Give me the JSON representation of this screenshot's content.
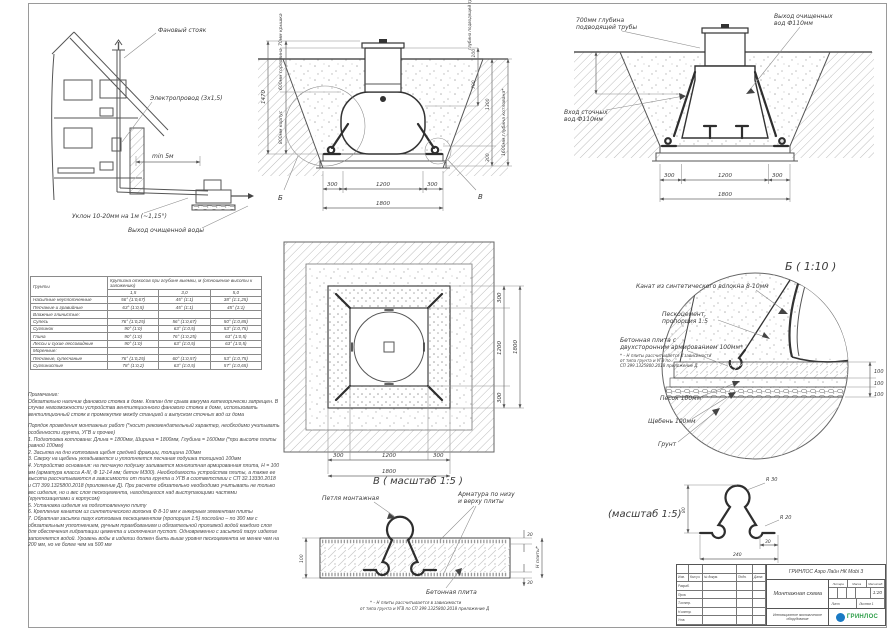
{
  "house": {
    "vent_stack": "Фановый стояк",
    "cable": "Электропровод (3х1,5)",
    "distance": "min 5м",
    "slope": "Уклон 10-20мм на 1м (~1,15°)",
    "outlet": "Выход очищенной воды"
  },
  "section_main": {
    "dim_cover": "70мм крышка",
    "dim_neck": "600мм горловина",
    "dim_body": "800мм корпус",
    "dim_total_h": "1470",
    "lbl_pipe_depth": "глубина подводящей трубы",
    "dim_100": "100",
    "dim_700": "700",
    "dim_1300": "1300",
    "dim_300r": "300",
    "dim_pit": "1600мм глубина котлована*",
    "dim_b300l": "300",
    "dim_b1200": "1200",
    "dim_b300r": "300",
    "dim_b1800": "1800",
    "callout_b": "Б",
    "callout_v": "В"
  },
  "section_right": {
    "lbl_pipe_depth_1": "700мм глубина",
    "lbl_pipe_depth_2": "подводящей трубы",
    "lbl_outlet_1": "Выход очищенных",
    "lbl_outlet_2": "вод Ф110мм",
    "lbl_inlet_1": "Вход сточных",
    "lbl_inlet_2": "вод Ф110мм",
    "dim_300l": "300",
    "dim_1200": "1200",
    "dim_300r": "300",
    "dim_1800": "1800"
  },
  "soils_table": {
    "col_soil": "Грунты",
    "col_group": "Крутизна откосов при глубине выемки, м (отношение высоты к заложению)",
    "depths": [
      "1,5",
      "3,0",
      "5,0"
    ],
    "rows": [
      {
        "name": "Насыпные неуплотненные",
        "v": [
          "56° (1:0,67)",
          "45° (1:1)",
          "38° (1:1,25)"
        ]
      },
      {
        "name": "Песчаные и гравийные",
        "v": [
          "63° (1:0,5)",
          "45° (1:1)",
          "45° (1:1)"
        ]
      },
      {
        "name": "Влажные глинистые:",
        "v": [
          "",
          "",
          ""
        ]
      },
      {
        "name": "Супесь",
        "v": [
          "76° (1:0,25)",
          "56° (1:0,67)",
          "50° (1:0,85)"
        ]
      },
      {
        "name": "Суглинок",
        "v": [
          "90° (1:0)",
          "63° (1:0,5)",
          "53° (1:0,75)"
        ]
      },
      {
        "name": "Глина",
        "v": [
          "90° (1:0)",
          "76° (1:0,25)",
          "63° (1:0,5)"
        ]
      },
      {
        "name": "Лессы и сухие лессовидные",
        "v": [
          "90° (1:0)",
          "63° (1:0,5)",
          "63° (1:0,5)"
        ]
      },
      {
        "name": "Моренные:",
        "v": [
          "",
          "",
          ""
        ]
      },
      {
        "name": "Песчаные, супесчаные",
        "v": [
          "76° (1:0,25)",
          "60° (1:0,57)",
          "53° (1:0,75)"
        ]
      },
      {
        "name": "Суглинистые",
        "v": [
          "78° (1:0,2)",
          "63° (1:0,5)",
          "57° (1:0,65)"
        ]
      }
    ]
  },
  "notes": {
    "title": "Примечание:",
    "para": "Обязательно наличие фанового стояка в доме. Клапан для срыва вакуума категорически запрещен. В случае невозможности устройства вентиляционного фанового стояка в доме, использовать вентиляционный стояк в промежутке между станцией и выпуском сточных вод из дома",
    "order_title": "Порядок проведения монтажных работ (*носит рекомендательный характер, необходимо учитывать особенности грунта, УГВ и прочее)",
    "items": [
      "1. Подготовка котлована: Длина = 1800мм,  Ширина = 1800мм,  Глубина = 1600мм (*при высоте плиты равной 100мм)",
      "2. Засыпка на дно котлована щебня средней фракции, толщина 100мм",
      "3. Сверху на щебень укладывается и уплотняется песчаная подушка толщиной 100мм",
      "4. Устройство основания: на песчаную подушку заливается монолитная армированная плита, Н = 100 мм (арматура класса А-III, Ф 12-14 мм; бетон М300). Необходимость устройства плиты, а также ее высота рассчитываются в зависимости от типа грунта и УГВ в соответствии с СП 32.13330.2018 и СП 399.1325800.2018 (приложение Д). При расчете обязательно необходимо учитывать не только вес изделия, но и вес слоя пескоцемента, находящегося над выступающими частями (грунтозацепами и корпусом)",
      "5. Установка изделия на подготовленную плиту",
      "6. Крепление канатом из синтетического волокна Ф 8-10 мм к анкерным элементам плиты",
      "7. Обратная засыпка пазух котлована пескоцементом (пропорция 1:5) послойно – по 300 мм с обязательным уплотнением, ручным трамбованием и обязательной проливкой водой каждого слоя для обеспечения гидратации цемента и исключения пустот. Одновременно с засыпкой пазух изделие заполняется водой. Уровень воды в изделии должен быть выше уровня пескоцемента не менее чем на 200 мм, но не более чем на 500 мм"
    ]
  },
  "plan": {
    "dim_300a": "300",
    "dim_1200a": "1200",
    "dim_300b": "300",
    "dim_1800a": "1800",
    "dim_300c": "300",
    "dim_1200b": "1200",
    "dim_300d": "300",
    "dim_1800b": "1800"
  },
  "detail_b": {
    "title": "Б ( 1:10 )",
    "rope": "Канат из синтетического волокна 8-10мм",
    "pesco_1": "Пескоцемент,",
    "pesco_2": "пропорция 1:5",
    "plate_1": "Бетонная плита с",
    "plate_2": "двухсторонним армированием 100мм*",
    "note_1": "* – Н плиты рассчитывается в зависимости",
    "note_2": "от типа грунта и УГВ по",
    "note_3": "СП 399.1325800.2018 приложение Д",
    "sand": "Песок 100мм",
    "gravel": "Щебень 100мм",
    "soil": "Грунт",
    "d1": "100",
    "d2": "100",
    "d3": "100"
  },
  "detail_v": {
    "title": "В ( масштаб 1:5 )",
    "loop": "Петля монтажная",
    "rebar_1": "Арматура по низу",
    "rebar_2": "и верху плиты",
    "plate": "Бетонная плита",
    "note_1": "* – Н плиты рассчитывается в зависимости",
    "note_2": "от типа грунта и УГВ по СП 399.1325800.2018 приложение Д",
    "d100": "100",
    "d30t": "30",
    "d30b": "30",
    "dh": "Н плиты*"
  },
  "rebar": {
    "title": "(масштаб 1:5)",
    "r30": "R 30",
    "r20": "R 20",
    "d80": "80",
    "d30": "30",
    "d240": "240"
  },
  "stamp": {
    "product": "ГРИНЛОС Аэро Лайн НК Mobi 3",
    "doc": "Монтажная схема",
    "tagline": "Инновационное экологическое оборудование",
    "logo": "ГРИНЛОС",
    "hdr": {
      "izm": "Изм.",
      "kol": "Кол.уч.",
      "doc": "№ докум.",
      "podp": "Подп.",
      "data": "Дата"
    },
    "rows": [
      "Разраб.",
      "Пров.",
      "Т.контр.",
      "Н.контр.",
      "Утв."
    ],
    "litera": "Литера",
    "massa": "Масса",
    "masshtab": "Масштаб",
    "scale": "1:20",
    "list": "Лист",
    "listov": "Листов 1"
  },
  "colors": {
    "logo_blue": "#1a7ac4",
    "logo_green": "#2e9e49"
  }
}
